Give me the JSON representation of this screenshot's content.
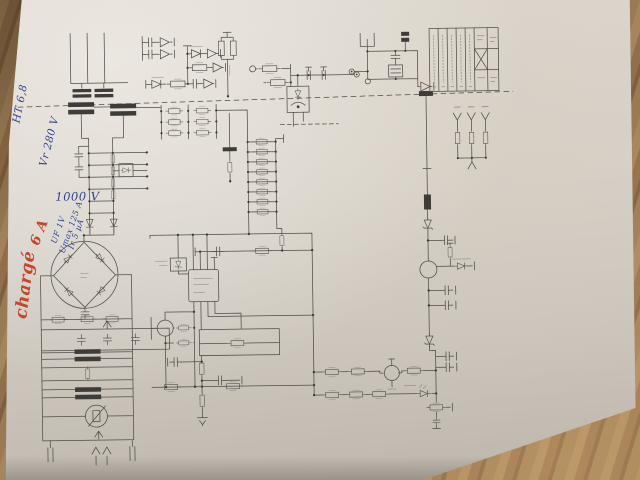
{
  "annotations": {
    "items": [
      {
        "id": "largeur",
        "text": "Largeur 15,7,",
        "color": "#31418f"
      },
      {
        "id": "ht",
        "text": "HT 6,8",
        "color": "#31418f"
      },
      {
        "id": "vr",
        "text": "Vr 280 V",
        "color": "#31418f"
      },
      {
        "id": "charge",
        "text": "chargé",
        "color": "#c2472f"
      },
      {
        "id": "amp",
        "text": "6 A",
        "color": "#c2472f"
      },
      {
        "id": "volts",
        "text": "1000 V",
        "color": "#31418f"
      },
      {
        "id": "uf",
        "text": "UF 1V",
        "color": "#31418f"
      },
      {
        "id": "umax",
        "text": "Umax 125 A",
        "color": "#31418f"
      },
      {
        "id": "ir",
        "text": "Ir 5 µA",
        "color": "#31418f"
      }
    ]
  },
  "schematic": {
    "icons": [
      "resistor-icon",
      "capacitor-icon",
      "diode-icon",
      "zener-diode-icon",
      "led-icon",
      "bridge-rectifier-icon",
      "transformer-icon",
      "optocoupler-icon",
      "ic-chip-icon",
      "transistor-icon",
      "varistor-icon",
      "inductor-icon",
      "ground-icon",
      "terminal-icon",
      "arrester-icon",
      "title-block-table"
    ]
  },
  "colors": {
    "schematic_ink": "#4f4e49",
    "paper": "#d6d1c9",
    "wood_table": "#8a6847",
    "annotation_blue": "#31418f",
    "annotation_red": "#c2472f"
  }
}
